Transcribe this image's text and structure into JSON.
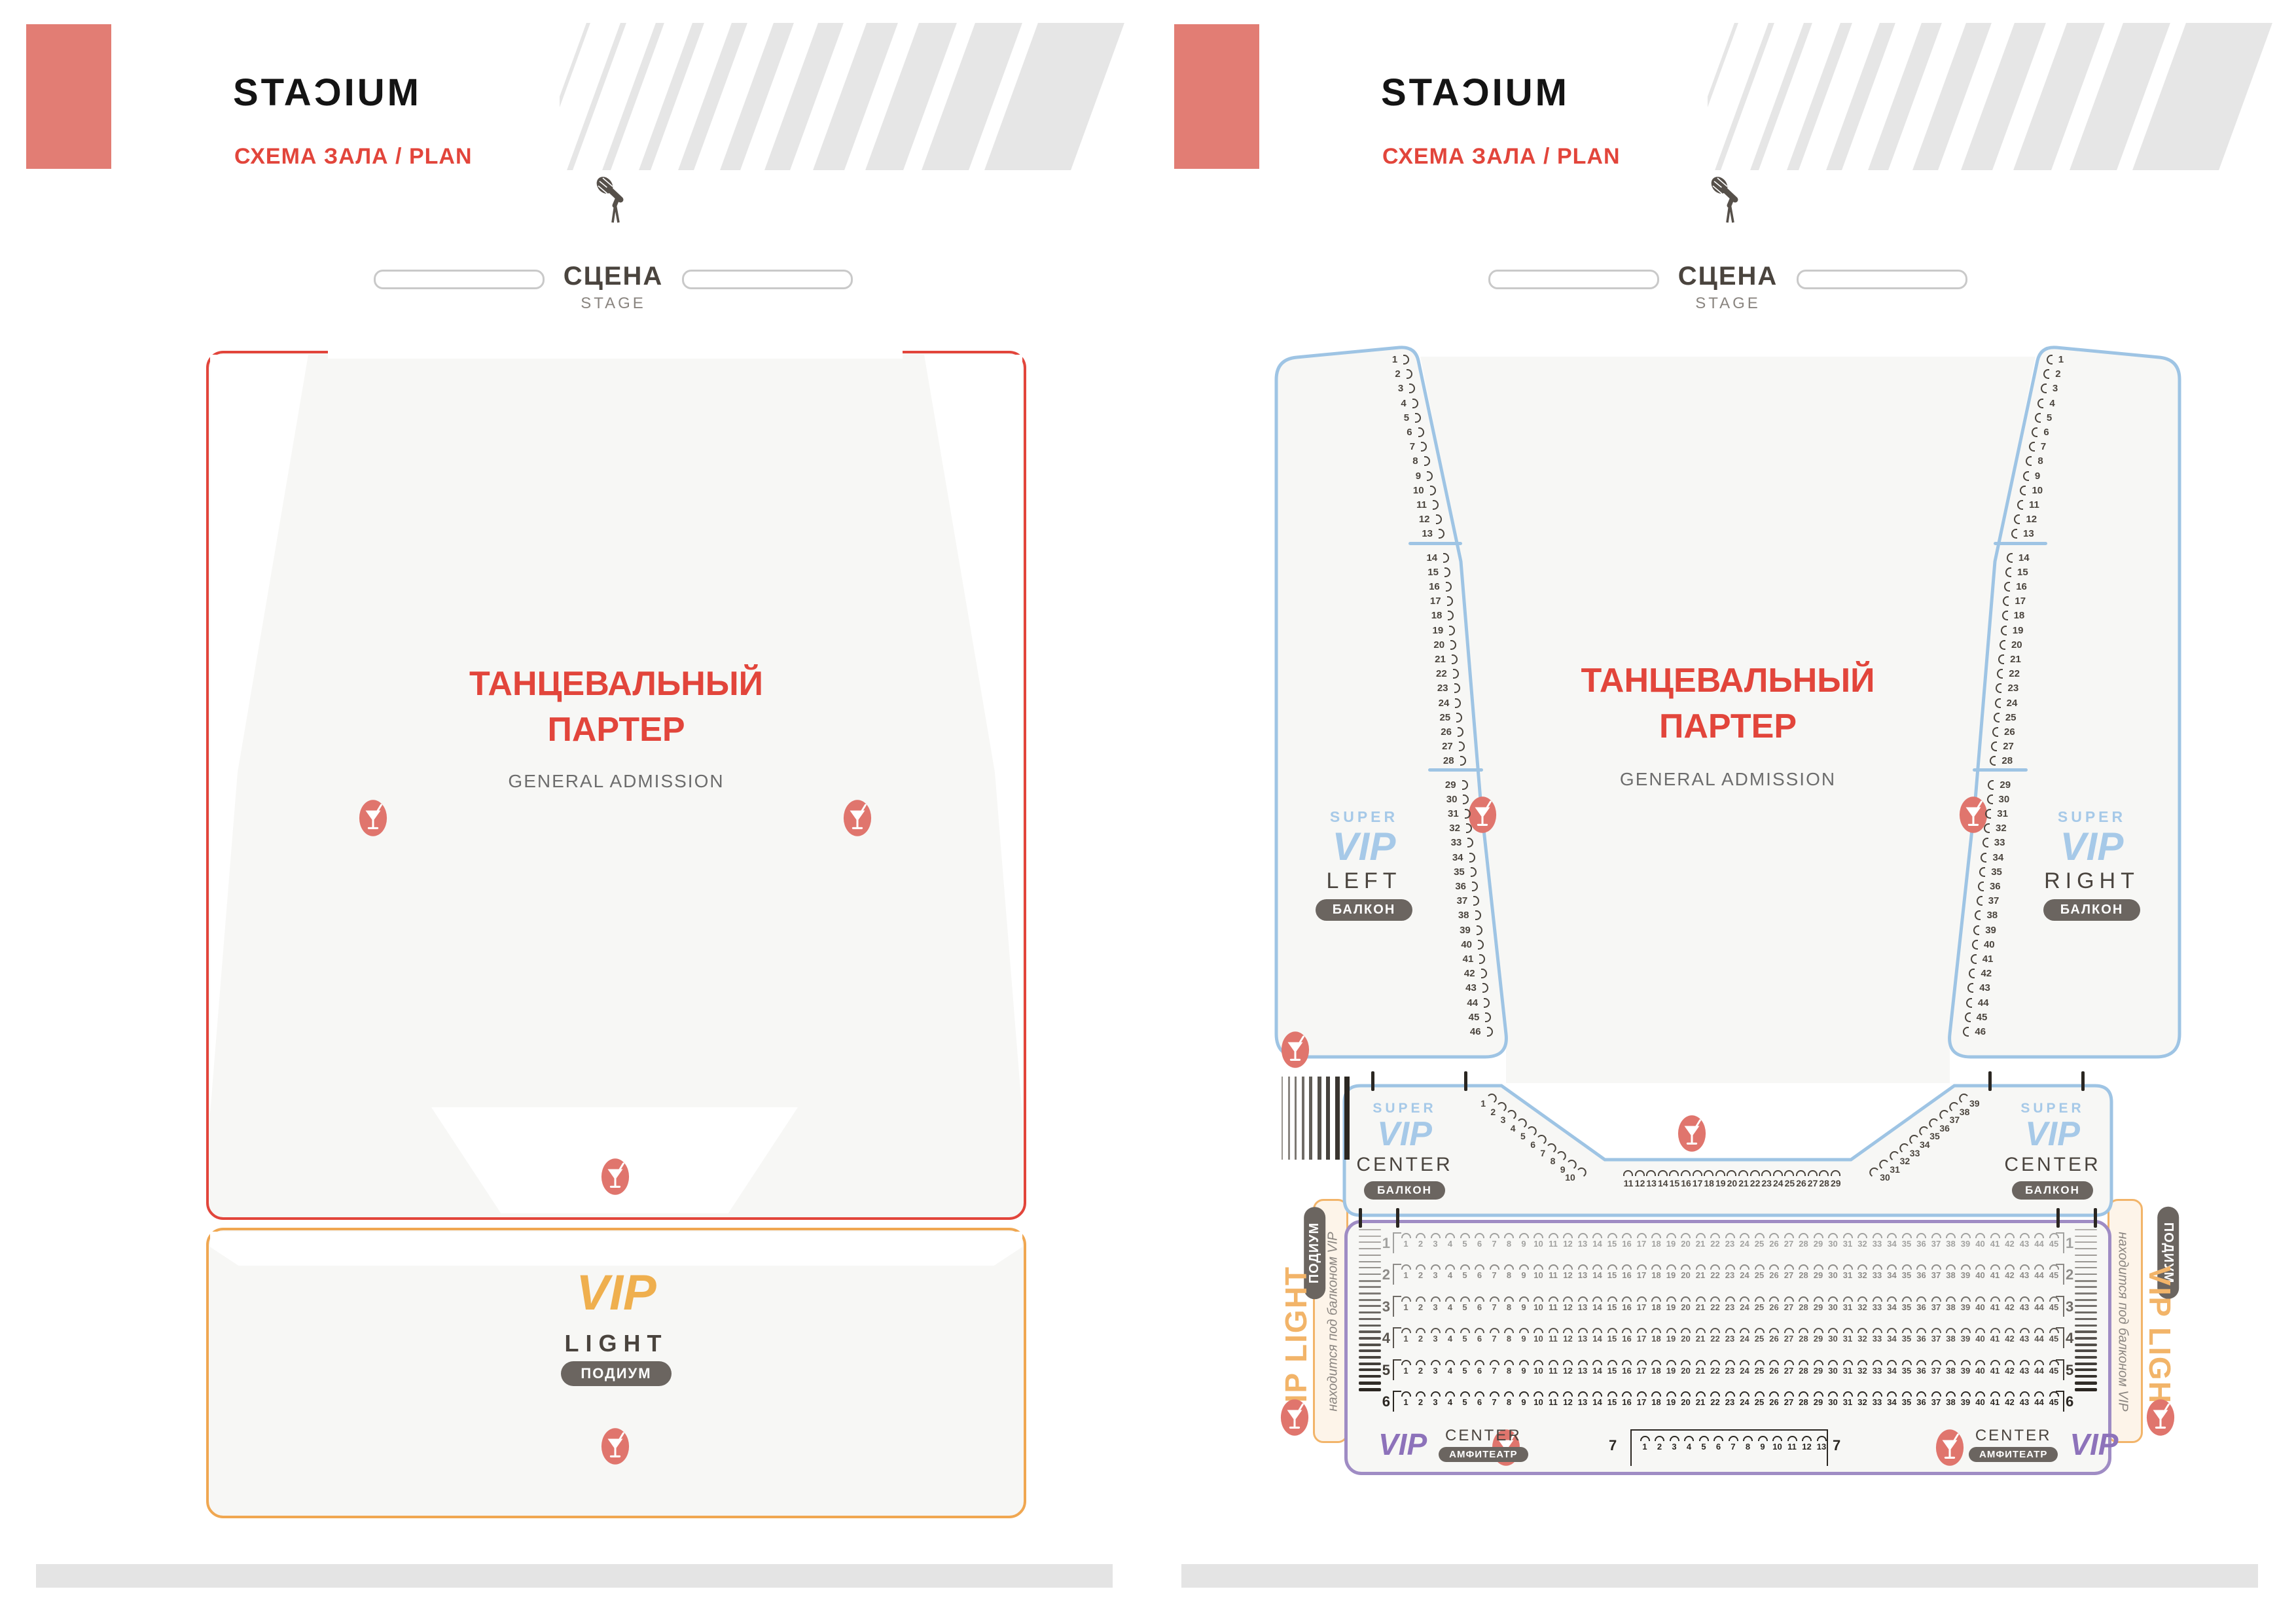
{
  "header": {
    "logo_part1": "STA",
    "logo_d": "Ɔ",
    "logo_part2": "IUM",
    "subtitle": "СХЕМА ЗАЛА / PLAN"
  },
  "stage": {
    "label": "СЦЕНА",
    "sublabel": "STAGE"
  },
  "ga": {
    "title1": "ТАНЦЕВАЛЬНЫЙ",
    "title2": "ПАРТЕР",
    "subtitle": "GENERAL ADMISSION"
  },
  "vip_light": {
    "vip": "VIP",
    "light": "LIGHT",
    "podium": "ПОДИУМ",
    "vertical_label": "VIP LIGHT",
    "note": "находится под балконом VIP"
  },
  "super_vip": {
    "super": "SUPER",
    "vip": "VIP",
    "left": "LEFT",
    "right": "RIGHT",
    "center": "CENTER",
    "balcony": "БАЛКОН"
  },
  "vip_center": {
    "vip": "VIP",
    "center": "CENTER",
    "amphitheatre": "АМФИТЕАТР",
    "row7": "7"
  },
  "seating": {
    "side_balconies": {
      "total": 46,
      "sections": [
        {
          "start": 1,
          "end": 13
        },
        {
          "start": 14,
          "end": 28
        },
        {
          "start": 29,
          "end": 46
        }
      ]
    },
    "center_balcony": {
      "left_diagonal": {
        "start": 1,
        "end": 10
      },
      "bottom": {
        "start": 11,
        "end": 29
      },
      "right_diagonal": {
        "start": 30,
        "end": 39
      }
    },
    "amphitheater": {
      "rows": [
        {
          "row": "1",
          "seats": 45
        },
        {
          "row": "2",
          "seats": 45
        },
        {
          "row": "3",
          "seats": 45
        },
        {
          "row": "4",
          "seats": 45
        },
        {
          "row": "5",
          "seats": 45
        },
        {
          "row": "6",
          "seats": 45
        },
        {
          "row": "7",
          "seats": 13
        }
      ],
      "row_colors": [
        "#a2a2a0",
        "#8e8c89",
        "#716d68",
        "#5a554f",
        "#423d37",
        "#2b2722",
        "#2b2722"
      ]
    }
  },
  "colors": {
    "salmon": "#e27d74",
    "red": "#e2453b",
    "orange": "#f0a751",
    "orange_text": "#efaf4e",
    "blue_border": "#9ec4e4",
    "blue_text": "#a6c9e8",
    "purple_border": "#9f8cc4",
    "purple_text": "#8d72ba",
    "pill_bg": "#6b6560",
    "seat_dark": "#4a443d",
    "floor": "#f7f7f5",
    "stripe_gray": "#e6e6e6",
    "cream": "#fdf4e9"
  }
}
